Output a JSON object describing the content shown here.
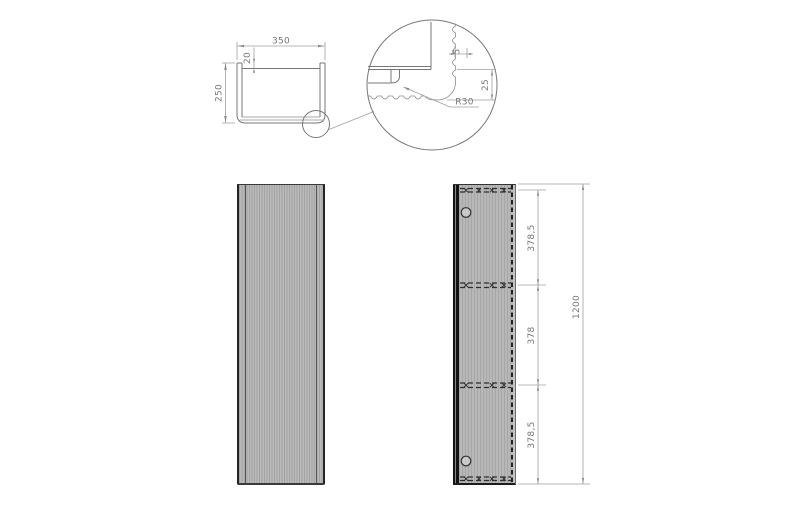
{
  "plan_view": {
    "width_mm": "350",
    "back_inset_mm": "20",
    "depth_mm": "250"
  },
  "detail_view": {
    "corner_radius": "R30",
    "panel_thickness_mm": "25",
    "flute_depth_mm": "5"
  },
  "side_view": {
    "section_top_mm": "378,5",
    "section_middle_mm": "378",
    "section_bottom_mm": "378,5",
    "overall_height_mm": "1200"
  },
  "colors": {
    "panel_fill": "#b4b4b4",
    "panel_stripe": "#a3a3a3",
    "edge_dark": "#242424",
    "drawing_line": "#777777",
    "dimension_line": "#a0a0a0",
    "dimension_text": "#767676",
    "background": "#ffffff"
  }
}
